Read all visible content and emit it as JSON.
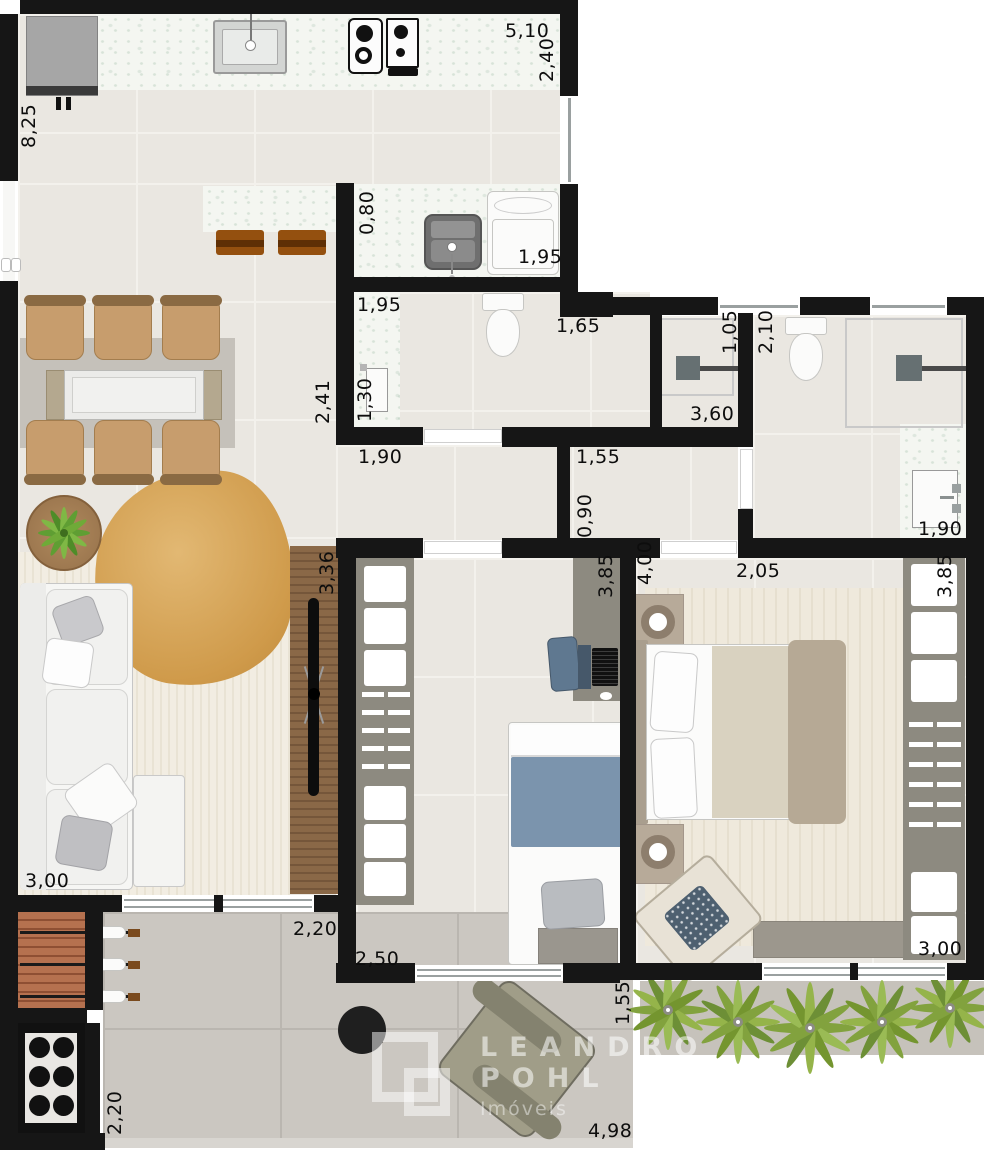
{
  "brand": {
    "name_line1": "LEANDRO",
    "name_line2": "POHL",
    "tagline": "Imóveis"
  },
  "dimensions": {
    "kitchen_width": "5,10",
    "kitchen_depth": "2,40",
    "left_side_height": "8,25",
    "laundry_passage": "0,80",
    "laundry_width": "1,95",
    "bathroom_width": "1,95",
    "bathroom_entry": "1,65",
    "bathroom_depth": "1,30",
    "shower_width": "1,05",
    "ensuite_width": "2,10",
    "hall_length": "3,60",
    "hall_width_a": "1,90",
    "hall_width_b": "1,55",
    "hall_width_c": "0,90",
    "living_wall": "2,41",
    "ensuite_vanity": "1,90",
    "master_entry": "2,05",
    "tv_panel_length": "3,36",
    "bedroom_depth": "3,85",
    "master_wardrobe_length": "3,85",
    "master_depth": "4,00",
    "sofa_wall": "3,00",
    "terrace_depth": "2,20",
    "terrace_opening": "2,50",
    "barbecue_depth": "2,20",
    "planter_width": "1,55",
    "master_bench": "3,00",
    "terrace_width": "4,98"
  }
}
